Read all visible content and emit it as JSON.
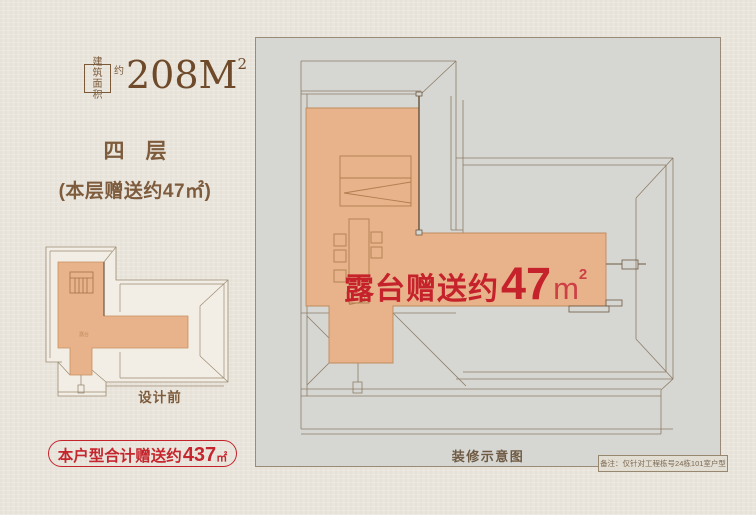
{
  "area_badge": {
    "box_row1": "建筑",
    "box_row2": "面积",
    "approx": "约",
    "value": "208M",
    "sup": "2"
  },
  "floor": {
    "title": "四　层",
    "gift_note": "(本层赠送约47㎡)"
  },
  "thumbnail": {
    "label": "设计前",
    "terrace_tiny": "露台"
  },
  "total_gift": {
    "prefix": "本户型合计赠送约",
    "value": "437",
    "unit": "㎡"
  },
  "main_plan": {
    "terrace": {
      "prefix": "露台赠送约",
      "value": "47",
      "unit": "m",
      "sup": "2"
    },
    "caption": "装修示意图",
    "note": "备注：仅针对工程栋号24栋101室户型"
  },
  "colors": {
    "accent_red": "#c5232b",
    "terrace_fill": "#e8b28a",
    "brown_text": "#7b5a3a",
    "panel_bg": "#d6d7d3",
    "roof_line": "#8e7c65",
    "wall_line": "#6e5942",
    "page_bg": "#e9e5dc"
  }
}
